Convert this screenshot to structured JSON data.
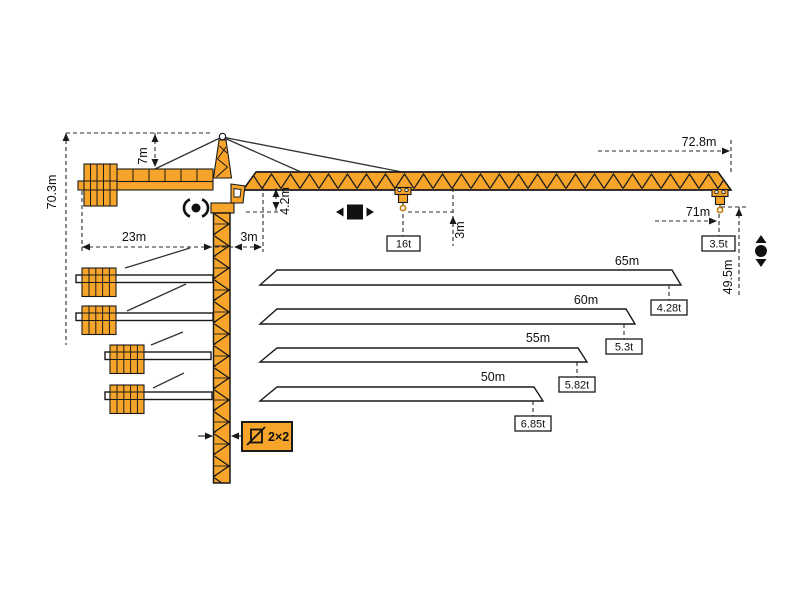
{
  "colors": {
    "crane_orange": "#F7A42A",
    "outline": "#1a1a1a"
  },
  "crane": {
    "dims": {
      "total_height": "70.3m",
      "apex_above_jib": "7m",
      "counter_jib_radius": "23m",
      "min_hook_radius": "3m",
      "jib_root_height": "4.2m",
      "hook_to_jib": "3m",
      "max_capacity": "16t",
      "max_jib_length": "72.8m",
      "max_hook_radius": "71m",
      "tip_capacity": "3.5t",
      "hook_height_at_tip": "49.5m",
      "mast_section": "2×2"
    },
    "jib_variants": [
      {
        "length": "65m",
        "tip_capacity": "4.28t"
      },
      {
        "length": "60m",
        "tip_capacity": "5.3t"
      },
      {
        "length": "55m",
        "tip_capacity": "5.82t"
      },
      {
        "length": "50m",
        "tip_capacity": "6.85t"
      }
    ],
    "symbols": {
      "slewing": "slewing-rotation-icon",
      "trolley": "trolley-travel-icon",
      "hoist": "hoist-up-down-icon",
      "section": "mast-cross-section-icon"
    }
  }
}
